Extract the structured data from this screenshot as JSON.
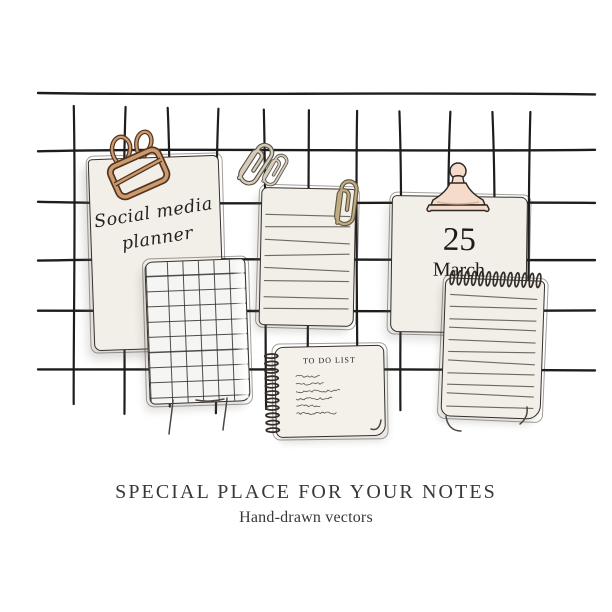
{
  "planner_card": {
    "line1": "Social media",
    "line2": "planner"
  },
  "calendar_card": {
    "day": "25",
    "month": "March"
  },
  "todo_card": {
    "title": "TO DO LIST"
  },
  "footer": {
    "title": "SPECIAL PLACE FOR YOUR NOTES",
    "subtitle": "Hand-drawn vectors"
  },
  "icons": {
    "binder_clip": "copper binder clip",
    "paper_clips": "two hanging paper clips",
    "lined_paper_clip": "gold paper clip",
    "calendar_clip": "blush bulldog clip",
    "spiral_coils": "notebook spiral binding",
    "spiral_rings": "notepad side rings"
  },
  "colors": {
    "paper": "#f2eee8",
    "paper_bright": "#f5f5f3",
    "ink": "#26221e",
    "grid_line": "#1d1d1d",
    "rule_line": "#6e6962",
    "copper": "#cb9b6d",
    "copper_dark": "#54341f",
    "tan": "#d6ccb8",
    "tan_dark": "#55504a",
    "gold": "#c0ab84",
    "gold_dark": "#5e563f",
    "blush": "#f5dcca",
    "blush_dark": "#dfb29a",
    "text": "#3b3734"
  }
}
